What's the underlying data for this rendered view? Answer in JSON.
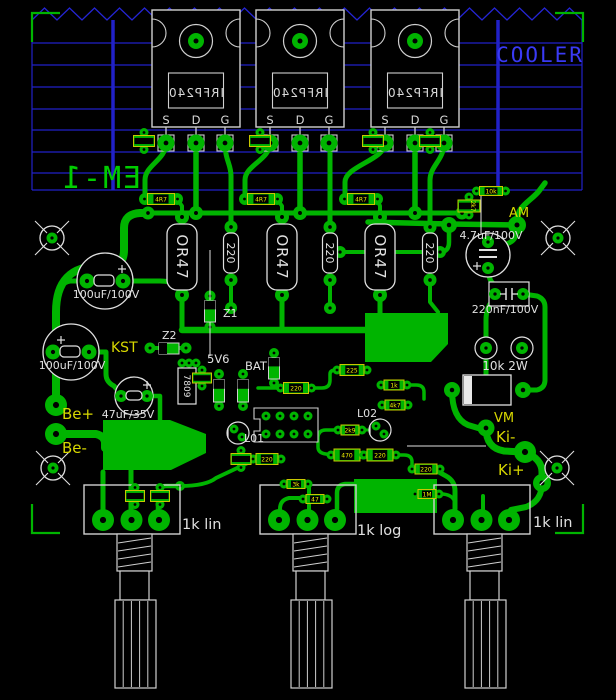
{
  "title": "EM-1",
  "colors": {
    "background": "#000000",
    "copper": "#00b400",
    "silk": "#e0e0e0",
    "heatsink_blue": "#2121c8",
    "cooler_text_blue": "#3a3af5",
    "label_yellow": "#d8d800",
    "smd_outline_yellow": "#c8c800",
    "smd_text_yellow": "#f0f000",
    "board_text_green": "#00cc00"
  },
  "heatsink": {
    "label": "COOLER"
  },
  "board": {
    "name": "EM-1"
  },
  "transistors": {
    "part": "IRFP240",
    "pins": [
      "S",
      "D",
      "G"
    ],
    "count": 3
  },
  "power_resistors": {
    "source": "OR47",
    "gate": "220",
    "bleeder": "10k 2W"
  },
  "capacitors": {
    "c1": "100uF/100V",
    "c2": "100uF/100V",
    "c3": "47uF/35V",
    "c4": "4.7uF/100V",
    "c5": "220nF/100V"
  },
  "semiconductors": {
    "z1": "Z1",
    "z2": "Z2",
    "zener": "5V6",
    "bat": "BAT",
    "regulator": "7809",
    "led1": "L01",
    "led2": "L02"
  },
  "terminals": {
    "kst": "KST",
    "am": "AM",
    "be_plus": "Be+",
    "be_minus": "Be-",
    "vm": "VM",
    "ki_minus": "Ki-",
    "ki_plus": "Ki+"
  },
  "potentiometers": [
    "1k lin",
    "1k log",
    "1k lin"
  ],
  "smd_values": [
    "4R7",
    "4R7",
    "4R7",
    "10k",
    "2k7",
    "220",
    "225",
    "1k",
    "4k7",
    "2k9",
    "470",
    "220",
    "220",
    "1M",
    "47",
    "3k",
    "220"
  ]
}
